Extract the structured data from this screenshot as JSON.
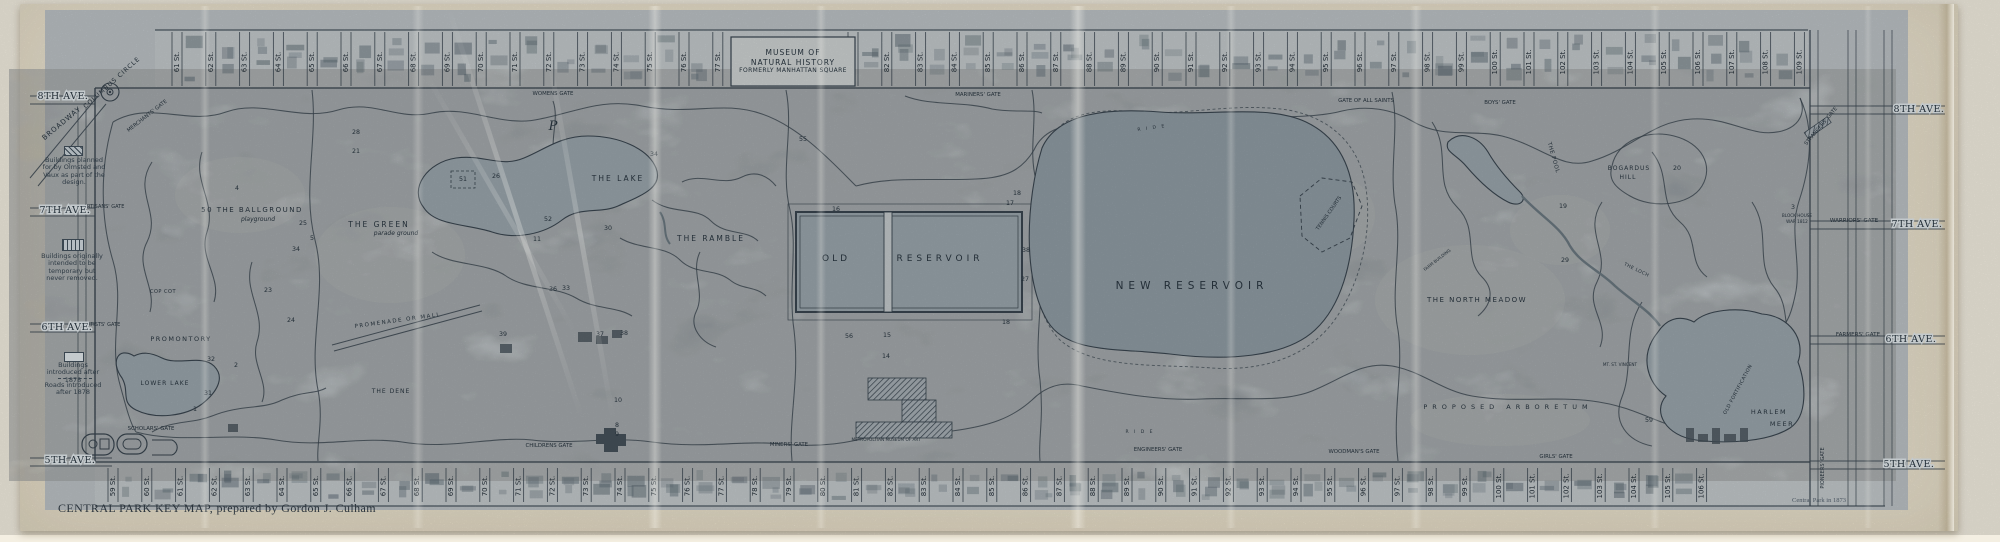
{
  "palette": {
    "print": "#bcc2c6",
    "park": "#afb7bd",
    "band": "#c3c9cc",
    "ink": "#39454f",
    "inkDark": "#232e37",
    "water": "#9aa5ac",
    "waterDark": "#909ca4",
    "stream": "#6b7880",
    "bldg": "#5c6a73",
    "bldgDark": "#46515a",
    "labelBox": "#ced3d2",
    "lawn": "#c7cccd",
    "paper": "#eee6d3"
  },
  "sheet": {
    "caption": "CENTRAL PARK KEY MAP, prepared by Gordon J. Culham",
    "imprint": "Central Park in 1873"
  },
  "museum": {
    "lines": [
      "MUSEUM OF",
      "NATURAL HISTORY",
      "FORMERLY MANHATTAN SQUARE"
    ]
  },
  "legend": {
    "items": [
      {
        "kind": "hatched",
        "text": "Buildings planned for by Olmsted and Vaux as part of the design."
      },
      {
        "kind": "striped",
        "text": "Buildings originally intended to be temporary but never removed."
      },
      {
        "kind": "outline",
        "text": "Buildings introduced after 1878"
      },
      {
        "kind": "dashed",
        "text": "Roads introduced after 1878"
      }
    ]
  },
  "map": {
    "streets": {
      "suffix": "St.",
      "top": {
        "from": 61,
        "to": 109,
        "skip": [
          78,
          79,
          80
        ],
        "x0": 177,
        "dx": 33.8,
        "y1": 32,
        "y2": 86,
        "ly": 62,
        "by": 34,
        "bh": 48
      },
      "bottom": {
        "from": 59,
        "to": 106,
        "skip": [],
        "x0": 113,
        "dx": 33.8,
        "y1": 468,
        "y2": 502,
        "ly": 486,
        "by": 470,
        "bh": 30
      }
    },
    "avenues": {
      "left": [
        [
          "8TH AVE.",
          63,
          99
        ],
        [
          "7TH AVE.",
          65,
          213
        ],
        [
          "6TH AVE.",
          67,
          330
        ],
        [
          "5TH AVE.",
          70,
          463
        ]
      ],
      "right": [
        [
          "8TH AVE.",
          1919,
          112
        ],
        [
          "7TH AVE.",
          1917,
          227
        ],
        [
          "6TH AVE.",
          1911,
          342
        ],
        [
          "5TH AVE.",
          1909,
          467
        ]
      ]
    },
    "gates": [
      {
        "t": "MERCHANTS' GATE",
        "x": 148,
        "y": 117,
        "s": 5.2,
        "r": -38
      },
      {
        "t": "WOMENS GATE",
        "x": 553,
        "y": 95,
        "s": 5.4
      },
      {
        "t": "MARINERS' GATE",
        "x": 978,
        "y": 96,
        "s": 5.4
      },
      {
        "t": "GATE OF ALL SAINTS",
        "x": 1366,
        "y": 102,
        "s": 5.4
      },
      {
        "t": "BOYS' GATE",
        "x": 1500,
        "y": 104,
        "s": 5.4
      },
      {
        "t": "STRANGERS' GATE",
        "x": 1822,
        "y": 127,
        "s": 5.2,
        "r": -50
      },
      {
        "t": "WARRIORS' GATE",
        "x": 1854,
        "y": 222,
        "s": 5.6
      },
      {
        "t": "ARTISANS' GATE",
        "x": 104,
        "y": 208,
        "s": 5
      },
      {
        "t": "ARTISTS' GATE",
        "x": 102,
        "y": 326,
        "s": 5
      },
      {
        "t": "SCHOLARS' GATE",
        "x": 151,
        "y": 430,
        "s": 5.4
      },
      {
        "t": "CHILDRENS GATE",
        "x": 549,
        "y": 447,
        "s": 5.4
      },
      {
        "t": "MINERS' GATE",
        "x": 789,
        "y": 446,
        "s": 5.4
      },
      {
        "t": "ENGINEERS' GATE",
        "x": 1158,
        "y": 451,
        "s": 5.4
      },
      {
        "t": "WOODMAN'S GATE",
        "x": 1354,
        "y": 453,
        "s": 5.4
      },
      {
        "t": "GIRLS' GATE",
        "x": 1556,
        "y": 458,
        "s": 5.4
      },
      {
        "t": "FARMERS' GATE",
        "x": 1858,
        "y": 336,
        "s": 5.6
      },
      {
        "t": "PIONEERS' GATE",
        "x": 1824,
        "y": 468,
        "s": 5,
        "r": -90
      }
    ],
    "features": [
      {
        "t": "COLUMBUS CIRCLE",
        "x": 113,
        "y": 84,
        "s": 6.2,
        "sp": 1,
        "r": -42
      },
      {
        "t": "BROADWAY",
        "x": 63,
        "y": 125,
        "s": 7,
        "sp": 1,
        "r": -40
      },
      {
        "t": "50  THE  BALLGROUND",
        "x": 252,
        "y": 212,
        "s": 7,
        "sp": 1.5
      },
      {
        "t": "playground",
        "x": 258,
        "y": 221,
        "s": 6,
        "i": 1
      },
      {
        "t": "THE  GREEN",
        "x": 379,
        "y": 227,
        "s": 7.5,
        "sp": 2
      },
      {
        "t": "parade ground",
        "x": 396,
        "y": 235,
        "s": 6,
        "i": 1
      },
      {
        "t": "COP COT",
        "x": 163,
        "y": 293,
        "s": 5,
        "sp": 0.5
      },
      {
        "t": "PROMONTORY",
        "x": 181,
        "y": 341,
        "s": 6.5,
        "sp": 1.5
      },
      {
        "t": "LOWER LAKE",
        "x": 165,
        "y": 385,
        "s": 6,
        "sp": 1
      },
      {
        "t": "THE DENE",
        "x": 391,
        "y": 393,
        "s": 6,
        "sp": 1
      },
      {
        "t": "THE  LAKE",
        "x": 618,
        "y": 181,
        "s": 7.5,
        "sp": 2
      },
      {
        "t": "THE RAMBLE",
        "x": 711,
        "y": 241,
        "s": 7.5,
        "sp": 2
      },
      {
        "t": "PROMENADE OR MALL",
        "x": 398,
        "y": 322,
        "s": 5.5,
        "sp": 1.5,
        "r": -8
      },
      {
        "t": "OLD",
        "x": 836,
        "y": 261,
        "s": 9,
        "sp": 3
      },
      {
        "t": "RESERVOIR",
        "x": 940,
        "y": 261,
        "s": 9,
        "sp": 4
      },
      {
        "t": "NEW  RESERVOIR",
        "x": 1192,
        "y": 289,
        "s": 10.5,
        "sp": 5
      },
      {
        "t": "TENNIS COURTS",
        "x": 1330,
        "y": 214,
        "s": 5,
        "r": -55
      },
      {
        "t": "THE POOL",
        "x": 1552,
        "y": 158,
        "s": 5.5,
        "sp": 0.5,
        "r": 74
      },
      {
        "t": "BOGARDUS",
        "x": 1629,
        "y": 170,
        "s": 6,
        "sp": 1
      },
      {
        "t": "HILL",
        "x": 1628,
        "y": 179,
        "s": 6,
        "sp": 1
      },
      {
        "t": "THE NORTH MEADOW",
        "x": 1477,
        "y": 302,
        "s": 7,
        "sp": 1.5
      },
      {
        "t": "FARM BUILDING",
        "x": 1438,
        "y": 261,
        "s": 4.2,
        "r": -38
      },
      {
        "t": "THE LOCH",
        "x": 1636,
        "y": 271,
        "s": 4.6,
        "sp": 0.5,
        "r": 26
      },
      {
        "t": "BLOCK HOUSE",
        "x": 1797,
        "y": 217,
        "s": 4.2
      },
      {
        "t": "WAR 1812",
        "x": 1797,
        "y": 223,
        "s": 4.2
      },
      {
        "t": "OLD FORTIFICATION",
        "x": 1739,
        "y": 390,
        "s": 4.8,
        "sp": 0.5,
        "r": -62
      },
      {
        "t": "HARLEM",
        "x": 1769,
        "y": 414,
        "s": 6.5,
        "sp": 1.5
      },
      {
        "t": "MEER",
        "x": 1782,
        "y": 426,
        "s": 6.5,
        "sp": 1.5
      },
      {
        "t": "PROPOSED   ARBORETUM",
        "x": 1508,
        "y": 409,
        "s": 6.5,
        "sp": 5
      },
      {
        "t": "MT. ST. VINCENT",
        "x": 1620,
        "y": 366,
        "s": 4.2
      },
      {
        "t": "METROPOLITAN MUSEUM OF ART",
        "x": 886,
        "y": 441,
        "s": 4.2
      },
      {
        "t": "P",
        "x": 553,
        "y": 130,
        "s": 13,
        "i": 1,
        "serif": 1
      },
      {
        "t": "R I D E",
        "x": 1152,
        "y": 129,
        "s": 4.5,
        "sp": 2,
        "r": -8
      },
      {
        "t": "R I D E",
        "x": 1140,
        "y": 433,
        "s": 4.5,
        "sp": 2
      }
    ],
    "markers": [
      {
        "n": "1",
        "x": 195,
        "y": 411
      },
      {
        "n": "2",
        "x": 236,
        "y": 367
      },
      {
        "n": "31",
        "x": 208,
        "y": 395
      },
      {
        "n": "32",
        "x": 211,
        "y": 361
      },
      {
        "n": "4",
        "x": 237,
        "y": 190
      },
      {
        "n": "21",
        "x": 356,
        "y": 153
      },
      {
        "n": "28",
        "x": 356,
        "y": 134
      },
      {
        "n": "25",
        "x": 303,
        "y": 225
      },
      {
        "n": "5",
        "x": 312,
        "y": 240
      },
      {
        "n": "34",
        "x": 296,
        "y": 251
      },
      {
        "n": "23",
        "x": 268,
        "y": 292
      },
      {
        "n": "24",
        "x": 291,
        "y": 322
      },
      {
        "n": "51",
        "x": 463,
        "y": 181
      },
      {
        "n": "26",
        "x": 496,
        "y": 178
      },
      {
        "n": "52",
        "x": 548,
        "y": 221
      },
      {
        "n": "11",
        "x": 537,
        "y": 241
      },
      {
        "n": "30",
        "x": 608,
        "y": 230
      },
      {
        "n": "34",
        "x": 654,
        "y": 156
      },
      {
        "n": "36",
        "x": 553,
        "y": 291
      },
      {
        "n": "33",
        "x": 566,
        "y": 290
      },
      {
        "n": "39",
        "x": 503,
        "y": 336
      },
      {
        "n": "37",
        "x": 600,
        "y": 336
      },
      {
        "n": "38",
        "x": 624,
        "y": 335
      },
      {
        "n": "10",
        "x": 618,
        "y": 402
      },
      {
        "n": "8",
        "x": 617,
        "y": 427
      },
      {
        "n": "9",
        "x": 617,
        "y": 436
      },
      {
        "n": "55",
        "x": 803,
        "y": 141
      },
      {
        "n": "16",
        "x": 836,
        "y": 211
      },
      {
        "n": "56",
        "x": 849,
        "y": 338
      },
      {
        "n": "15",
        "x": 887,
        "y": 337
      },
      {
        "n": "14",
        "x": 886,
        "y": 358
      },
      {
        "n": "17",
        "x": 1010,
        "y": 205
      },
      {
        "n": "18",
        "x": 1017,
        "y": 195
      },
      {
        "n": "38",
        "x": 1026,
        "y": 252
      },
      {
        "n": "27",
        "x": 1025,
        "y": 281
      },
      {
        "n": "18",
        "x": 1006,
        "y": 324
      },
      {
        "n": "19",
        "x": 1563,
        "y": 208
      },
      {
        "n": "29",
        "x": 1565,
        "y": 262
      },
      {
        "n": "20",
        "x": 1677,
        "y": 170
      },
      {
        "n": "3",
        "x": 1793,
        "y": 209
      },
      {
        "n": "59",
        "x": 1649,
        "y": 422
      }
    ]
  }
}
